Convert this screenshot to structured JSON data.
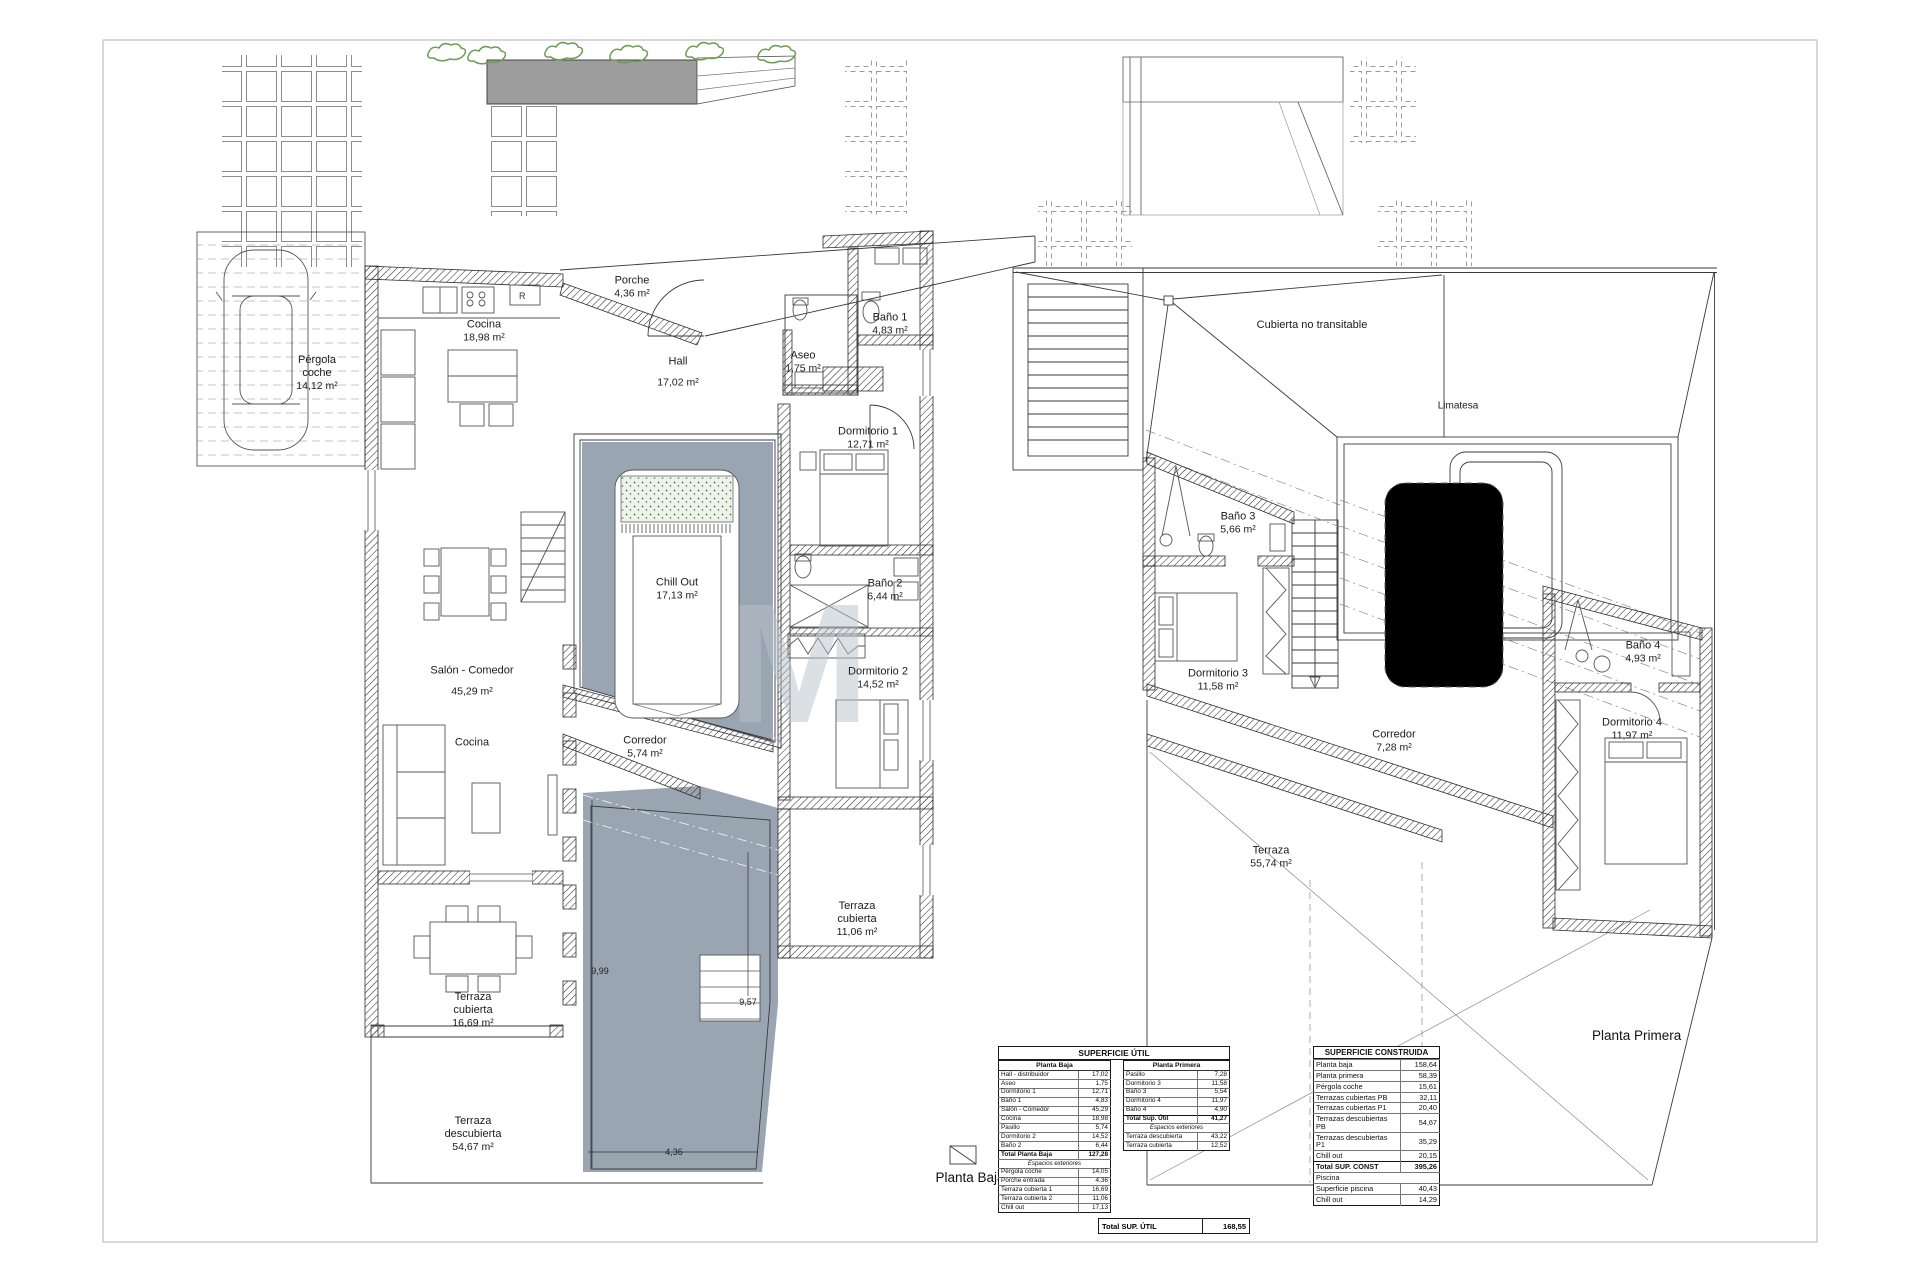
{
  "colors": {
    "patio": "#9aa5b2",
    "pool": "#9aa5b2",
    "vegetation": "#6f9c55",
    "watermark": "#b9c2ca"
  },
  "watermark": {
    "letter": "M",
    "sub": "I N"
  },
  "titles": {
    "baja": "Planta Baja",
    "primera": "Planta Primera"
  },
  "plans": {
    "baja": {
      "kitchen_r": "R",
      "rooms": {
        "pergola": {
          "name": "Pérgola coche",
          "area": "14,12 m²"
        },
        "porche": {
          "name": "Porche",
          "area": "4,36 m²"
        },
        "cocina": {
          "name": "Cocina",
          "area": "18,98 m²"
        },
        "hall": {
          "name": "Hall",
          "area": "17,02 m²"
        },
        "aseo": {
          "name": "Aseo",
          "area": "1,75 m²"
        },
        "banio1": {
          "name": "Baño 1",
          "area": "4,83 m²"
        },
        "dorm1": {
          "name": "Dormitorio 1",
          "area": "12,71 m²"
        },
        "chillout": {
          "name": "Chill Out",
          "area": "17,13 m²"
        },
        "banio2": {
          "name": "Baño 2",
          "area": "6,44 m²"
        },
        "dorm2": {
          "name": "Dormitorio 2",
          "area": "14,52 m²"
        },
        "salon": {
          "name": "Salón - Comedor",
          "area": "45,29 m²"
        },
        "cocina2": {
          "name": "Cocina",
          "area": ""
        },
        "corredor": {
          "name": "Corredor",
          "area": "5,74 m²"
        },
        "tcub1": {
          "name": "Terraza cubierta",
          "area": "16,69 m²"
        },
        "tcub2": {
          "name": "Terraza cubierta",
          "area": "11,06 m²"
        },
        "tdesc": {
          "name": "Terraza descubierta",
          "area": "54,67 m²"
        }
      },
      "dims": {
        "pool_length": "9,99",
        "pool_inner": "9,57",
        "pool_width": "4,36"
      }
    },
    "primera": {
      "roof_label": "Cubierta no transitable",
      "ridge_label": "Limatesa",
      "rooms": {
        "banio3": {
          "name": "Baño 3",
          "area": "5,66 m²"
        },
        "dorm3": {
          "name": "Dormitorio 3",
          "area": "11,58 m²"
        },
        "corredor": {
          "name": "Corredor",
          "area": "7,28 m²"
        },
        "banio4": {
          "name": "Baño 4",
          "area": "4,93 m²"
        },
        "dorm4": {
          "name": "Dormitorio 4",
          "area": "11,97 m²"
        },
        "terraza": {
          "name": "Terraza",
          "area": "55,74 m²"
        }
      }
    }
  },
  "tables": {
    "util": {
      "title": "SUPERFICIE ÚTIL",
      "baja": {
        "header": "Planta Baja",
        "rows": [
          [
            "Hall - distribuidor",
            "17,02"
          ],
          [
            "Aseo",
            "1,75"
          ],
          [
            "Dormitorio 1",
            "12,71"
          ],
          [
            "Baño 1",
            "4,83"
          ],
          [
            "Salón - Comedor",
            "45,29"
          ],
          [
            "Cocina",
            "18,98"
          ],
          [
            "Pasillo",
            "5,74"
          ],
          [
            "Dormitorio 2",
            "14,52"
          ],
          [
            "Baño 2",
            "6,44"
          ]
        ],
        "total": [
          "Total Planta Baja",
          "127,28"
        ],
        "ext_header": "Espacios exteriores",
        "ext_rows": [
          [
            "Pérgola coche",
            "14,05"
          ],
          [
            "Porche entrada",
            "4,36"
          ],
          [
            "Terraza cubierta 1",
            "16,69"
          ],
          [
            "Terraza cubierta 2",
            "11,06"
          ],
          [
            "Chill out",
            "17,13"
          ]
        ]
      },
      "primera": {
        "header": "Planta Primera",
        "rows": [
          [
            "Pasillo",
            "7,28"
          ],
          [
            "Dormitorio 3",
            "11,58"
          ],
          [
            "Baño 3",
            "5,54"
          ],
          [
            "Dormitorio 4",
            "11,97"
          ],
          [
            "Baño 4",
            "4,90"
          ]
        ],
        "total": [
          "Total Sup. Útil",
          "41,27"
        ],
        "ext_header": "Espacios exteriores",
        "ext_rows": [
          [
            "Terraza descubierta",
            "43,22"
          ],
          [
            "Terraza cubierta",
            "12,52"
          ]
        ]
      },
      "total": {
        "label": "Total SUP. ÚTIL",
        "value": "168,55"
      }
    },
    "construida": {
      "title": "SUPERFICIE CONSTRUIDA",
      "rows": [
        [
          "Planta baja",
          "158,64"
        ],
        [
          "Planta primera",
          "58,39"
        ],
        [
          "Pérgola coche",
          "15,61"
        ],
        [
          "Terrazas cubiertas PB",
          "32,11"
        ],
        [
          "Terrazas cubiertas P1",
          "20,40"
        ],
        [
          "Terrazas descubiertas PB",
          "54,67"
        ],
        [
          "Terrazas descubiertas P1",
          "35,29"
        ],
        [
          "Chill out",
          "20,15"
        ]
      ],
      "total": [
        "Total SUP. CONST",
        "395,26"
      ]
    },
    "piscina": {
      "header": "Piscina",
      "rows": [
        [
          "Superficie piscina",
          "40,43"
        ],
        [
          "Chill out",
          "14,29"
        ]
      ]
    }
  }
}
